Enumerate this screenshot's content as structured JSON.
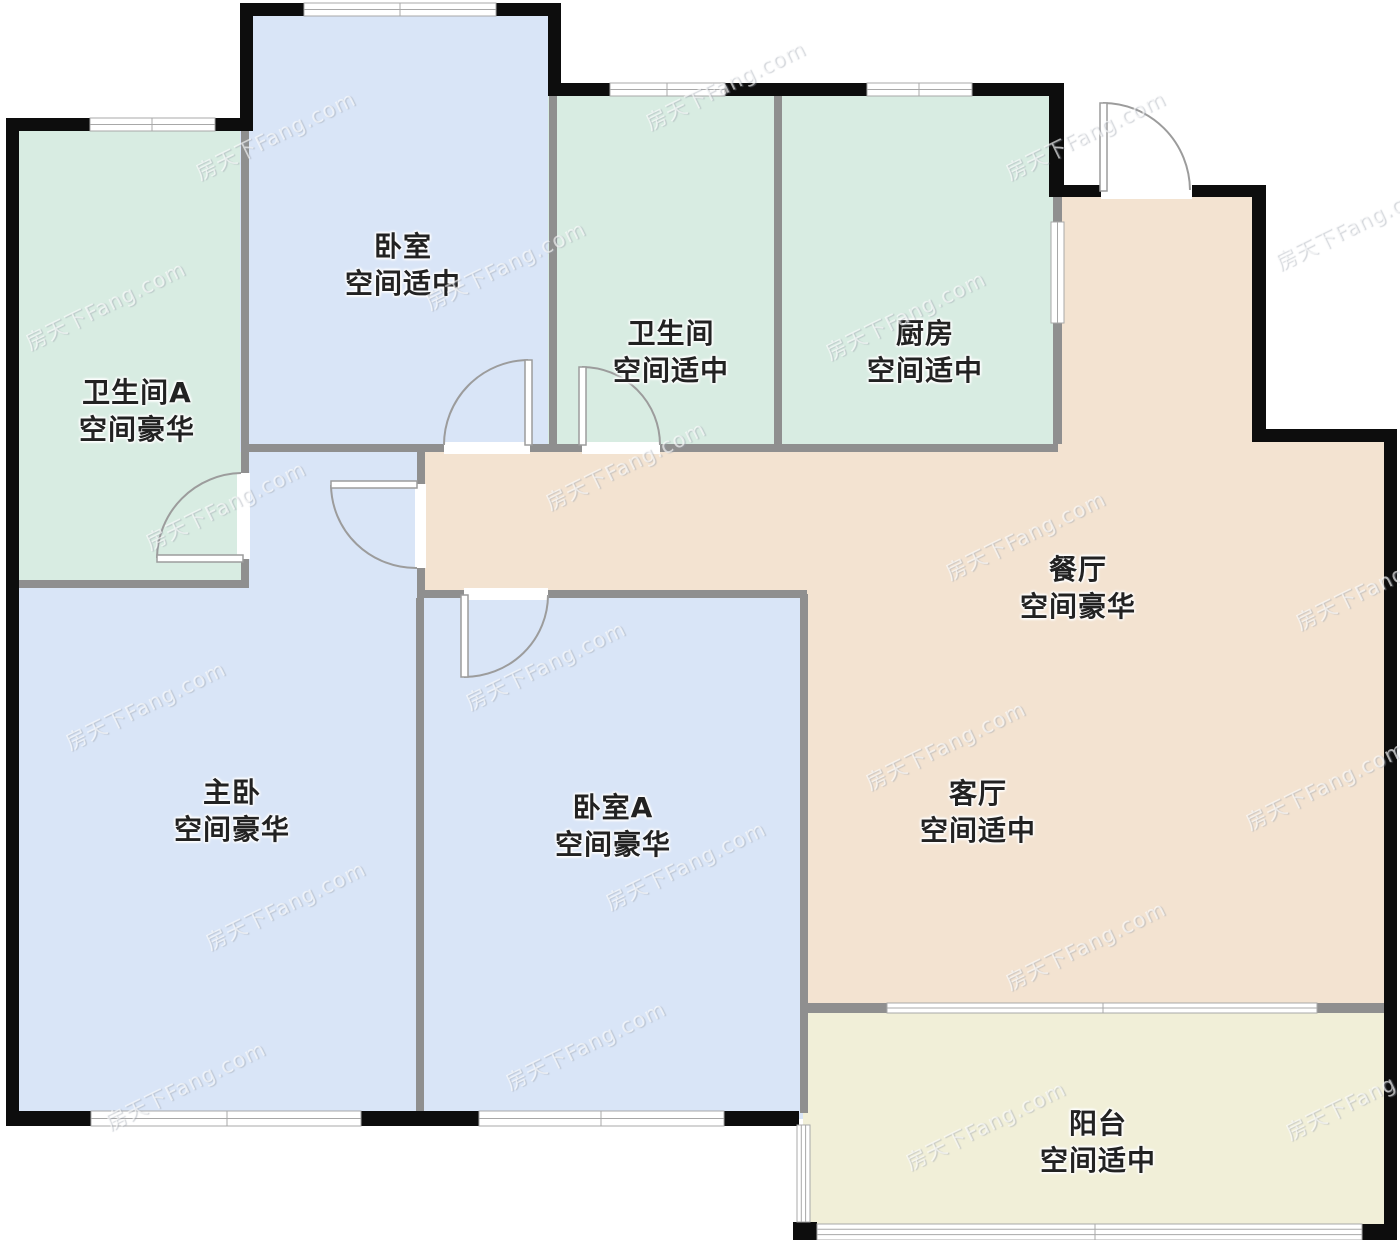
{
  "rooms": [
    {
      "name": "卧室",
      "note": "空间适中"
    },
    {
      "name": "卫生间A",
      "note": "空间豪华"
    },
    {
      "name": "卫生间",
      "note": "空间适中"
    },
    {
      "name": "厨房",
      "note": "空间适中"
    },
    {
      "name": "餐厅",
      "note": "空间豪华"
    },
    {
      "name": "客厅",
      "note": "空间适中"
    },
    {
      "name": "主卧",
      "note": "空间豪华"
    },
    {
      "name": "卧室A",
      "note": "空间豪华"
    },
    {
      "name": "阳台",
      "note": "空间适中"
    }
  ],
  "watermark": {
    "text": "房天下Fang.com"
  },
  "colors": {
    "wet_room": "#d8ece2",
    "bedroom": "#d9e5f7",
    "hall": "#f3e3d1",
    "balcony": "#f1efd8",
    "outer_wall": "#0d0d0d",
    "inner_wall": "#8f8f8f",
    "door_line": "#9c9c9c",
    "window_line": "#a8a8a8"
  }
}
